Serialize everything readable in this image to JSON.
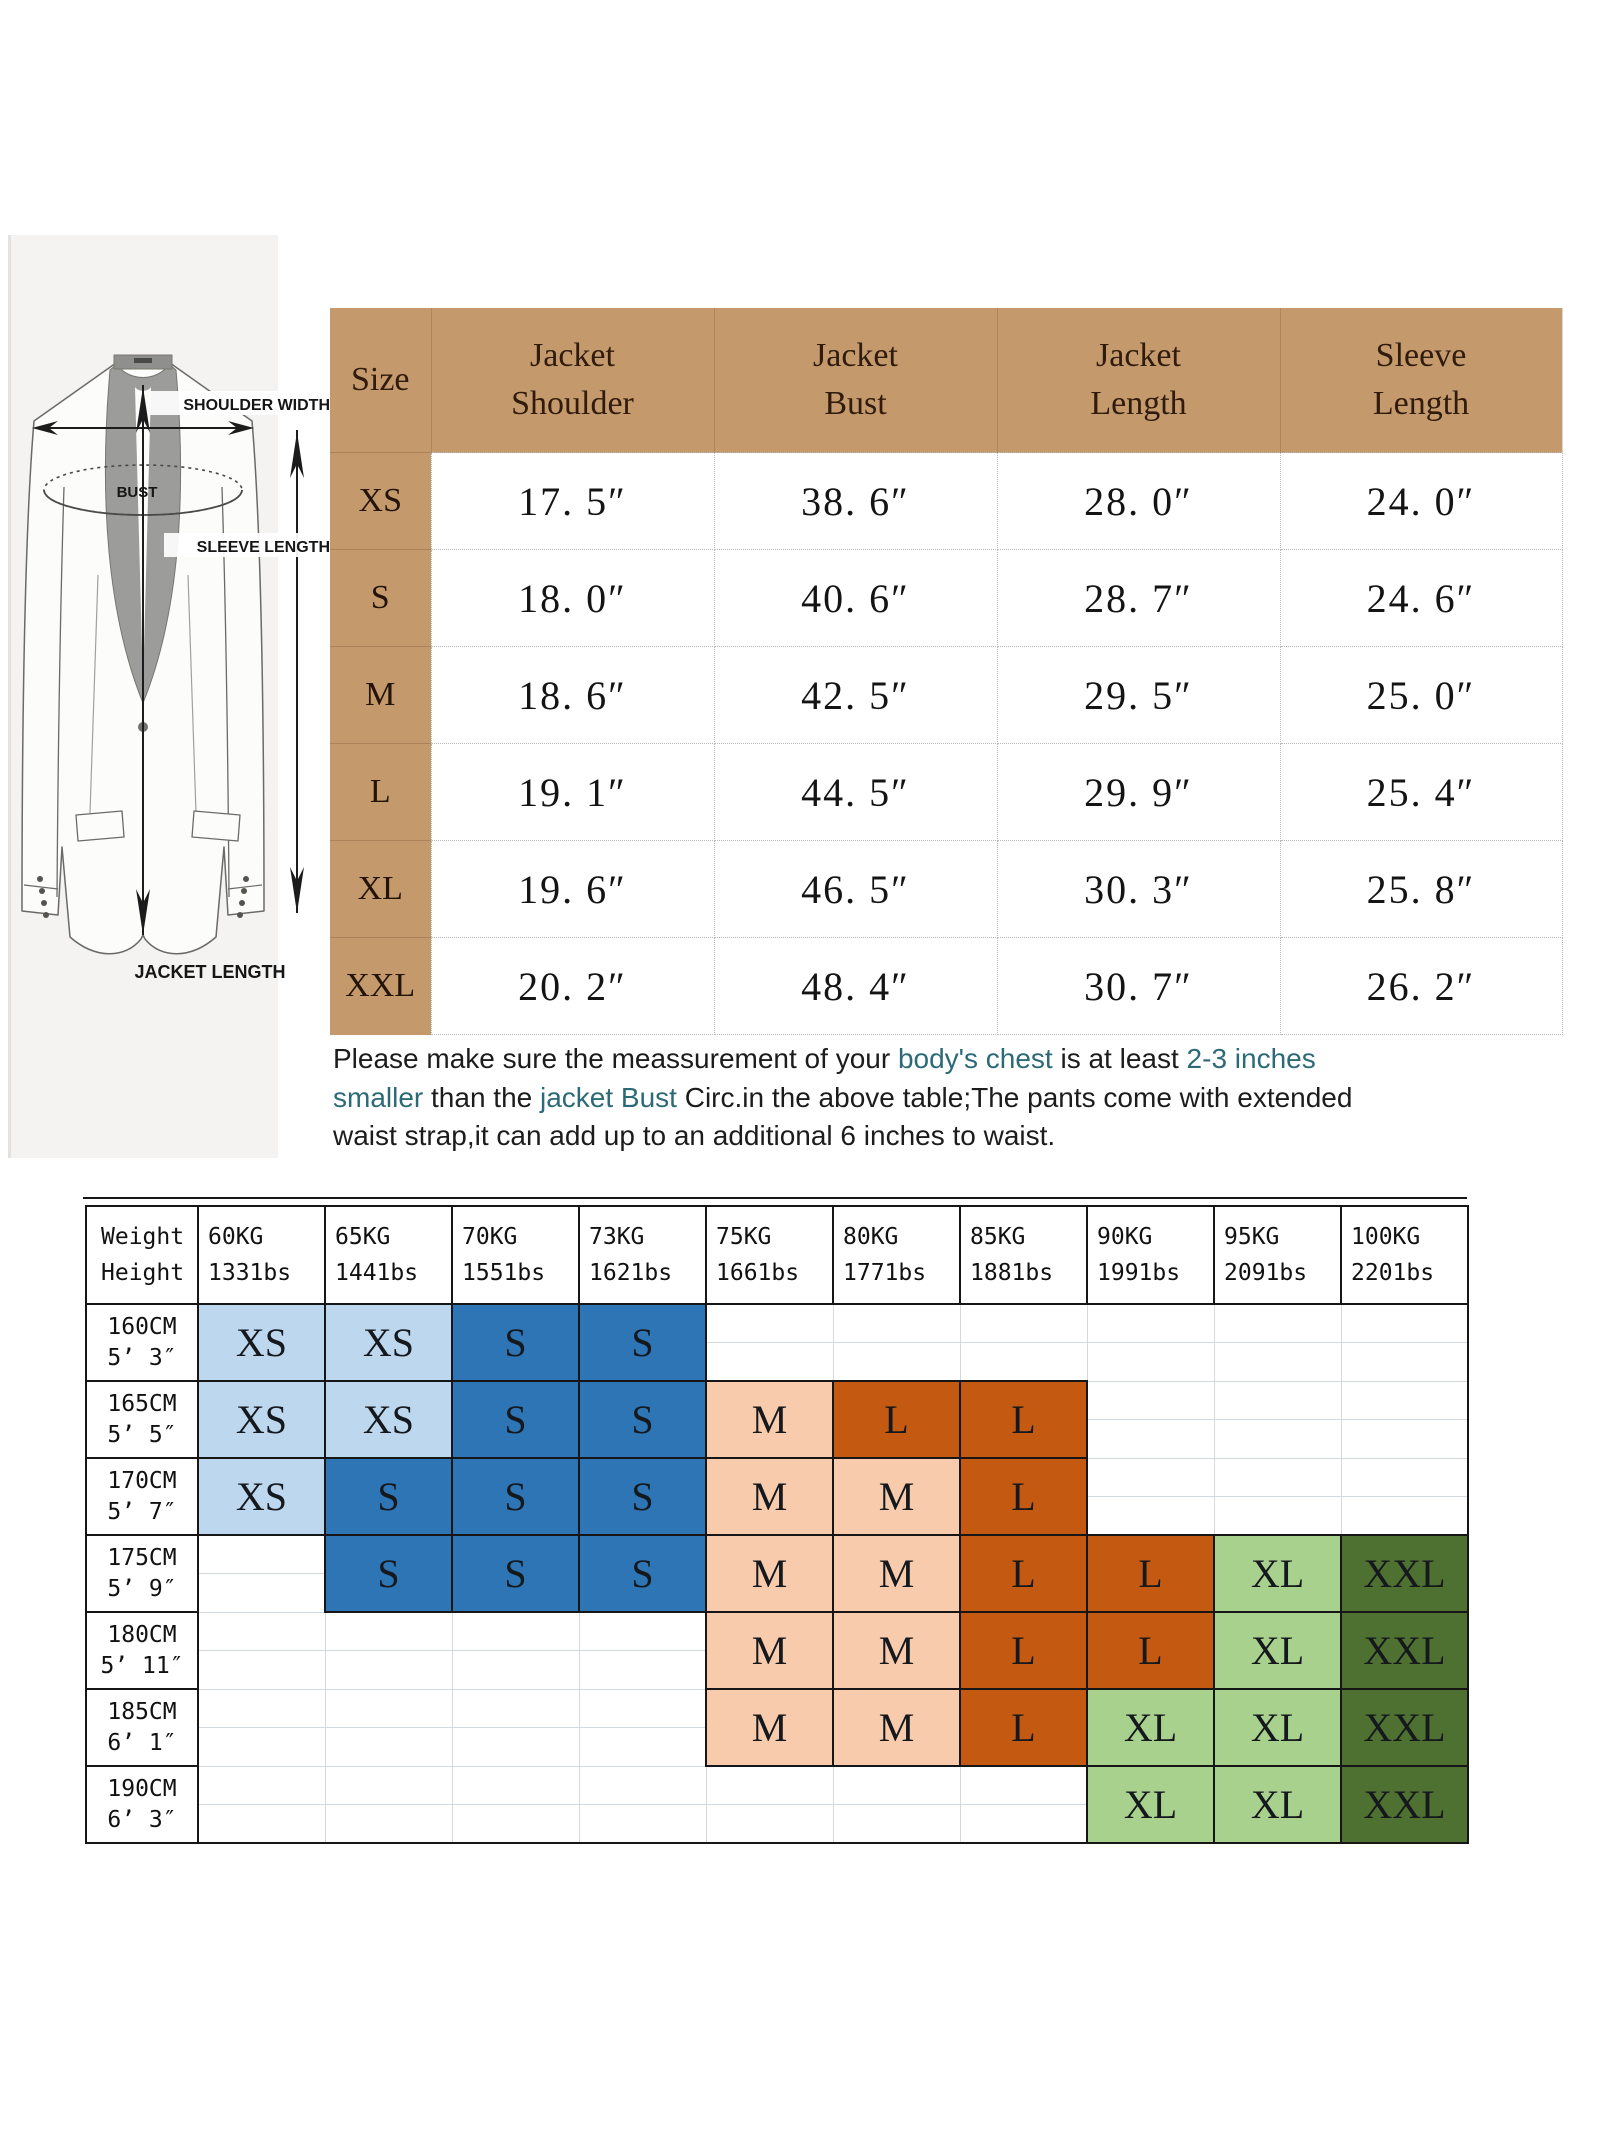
{
  "diagram": {
    "shoulder_label": "SHOULDER WIDTH",
    "bust_label": "BUST",
    "sleeve_label": "SLEEVE LENGTH",
    "length_label": "JACKET LENGTH"
  },
  "size_table": {
    "columns": [
      "Size",
      "Jacket\nShoulder",
      "Jacket\nBust",
      "Jacket\nLength",
      "Sleeve\nLength"
    ],
    "rows": [
      {
        "size": "XS",
        "values": [
          "17. 5″",
          "38. 6″",
          "28. 0″",
          "24. 0″"
        ]
      },
      {
        "size": "S",
        "values": [
          "18. 0″",
          "40. 6″",
          "28. 7″",
          "24. 6″"
        ]
      },
      {
        "size": "M",
        "values": [
          "18. 6″",
          "42. 5″",
          "29. 5″",
          "25. 0″"
        ]
      },
      {
        "size": "L",
        "values": [
          "19. 1″",
          "44. 5″",
          "29. 9″",
          "25. 4″"
        ]
      },
      {
        "size": "XL",
        "values": [
          "19. 6″",
          "46. 5″",
          "30. 3″",
          "25. 8″"
        ]
      },
      {
        "size": "XXL",
        "values": [
          "20. 2″",
          "48. 4″",
          "30. 7″",
          "26. 2″"
        ]
      }
    ]
  },
  "note": {
    "lines": [
      [
        {
          "t": "Please make sure the meassurement of your ",
          "teal": false
        },
        {
          "t": "body's chest",
          "teal": true
        },
        {
          "t": " is at least ",
          "teal": false
        },
        {
          "t": "2-3 inches",
          "teal": true
        }
      ],
      [
        {
          "t": "smaller",
          "teal": true
        },
        {
          "t": " than the ",
          "teal": false
        },
        {
          "t": "jacket Bust",
          "teal": true
        },
        {
          "t": " Circ.in the above table;The pants come with extended",
          "teal": false
        }
      ],
      [
        {
          "t": "waist strap,it can add up to an additional 6 inches to waist.",
          "teal": false
        }
      ]
    ]
  },
  "fit_table": {
    "corner": {
      "top": "Weight",
      "bottom": "Height"
    },
    "weights": [
      {
        "kg": "60KG",
        "lbs": "1331bs"
      },
      {
        "kg": "65KG",
        "lbs": "1441bs"
      },
      {
        "kg": "70KG",
        "lbs": "1551bs"
      },
      {
        "kg": "73KG",
        "lbs": "1621bs"
      },
      {
        "kg": "75KG",
        "lbs": "1661bs"
      },
      {
        "kg": "80KG",
        "lbs": "1771bs"
      },
      {
        "kg": "85KG",
        "lbs": "1881bs"
      },
      {
        "kg": "90KG",
        "lbs": "1991bs"
      },
      {
        "kg": "95KG",
        "lbs": "2091bs"
      },
      {
        "kg": "100KG",
        "lbs": "2201bs"
      }
    ],
    "rows": [
      {
        "cm": "160CM",
        "ft": "5’ 3″",
        "cells": [
          {
            "s": "XS",
            "c": "lightblue"
          },
          {
            "s": "XS",
            "c": "lightblue"
          },
          {
            "s": "S",
            "c": "blue"
          },
          {
            "s": "S",
            "c": "blue"
          },
          null,
          null,
          null,
          null,
          null,
          null
        ]
      },
      {
        "cm": "165CM",
        "ft": "5’ 5″",
        "cells": [
          {
            "s": "XS",
            "c": "lightblue"
          },
          {
            "s": "XS",
            "c": "lightblue"
          },
          {
            "s": "S",
            "c": "blue"
          },
          {
            "s": "S",
            "c": "blue"
          },
          {
            "s": "M",
            "c": "peach"
          },
          {
            "s": "L",
            "c": "orange"
          },
          {
            "s": "L",
            "c": "orange"
          },
          null,
          null,
          null
        ]
      },
      {
        "cm": "170CM",
        "ft": "5’ 7″",
        "cells": [
          {
            "s": "XS",
            "c": "lightblue"
          },
          {
            "s": "S",
            "c": "blue"
          },
          {
            "s": "S",
            "c": "blue"
          },
          {
            "s": "S",
            "c": "blue"
          },
          {
            "s": "M",
            "c": "peach"
          },
          {
            "s": "M",
            "c": "peach"
          },
          {
            "s": "L",
            "c": "orange"
          },
          null,
          null,
          null
        ]
      },
      {
        "cm": "175CM",
        "ft": "5’ 9″",
        "cells": [
          null,
          {
            "s": "S",
            "c": "blue"
          },
          {
            "s": "S",
            "c": "blue"
          },
          {
            "s": "S",
            "c": "blue"
          },
          {
            "s": "M",
            "c": "peach"
          },
          {
            "s": "M",
            "c": "peach"
          },
          {
            "s": "L",
            "c": "orange"
          },
          {
            "s": "L",
            "c": "orange"
          },
          {
            "s": "XL",
            "c": "lightgreen"
          },
          {
            "s": "XXL",
            "c": "darkgreen"
          }
        ]
      },
      {
        "cm": "180CM",
        "ft": "5’ 11″",
        "cells": [
          null,
          null,
          null,
          null,
          {
            "s": "M",
            "c": "peach"
          },
          {
            "s": "M",
            "c": "peach"
          },
          {
            "s": "L",
            "c": "orange"
          },
          {
            "s": "L",
            "c": "orange"
          },
          {
            "s": "XL",
            "c": "lightgreen"
          },
          {
            "s": "XXL",
            "c": "darkgreen"
          }
        ]
      },
      {
        "cm": "185CM",
        "ft": "6’ 1″",
        "cells": [
          null,
          null,
          null,
          null,
          {
            "s": "M",
            "c": "peach"
          },
          {
            "s": "M",
            "c": "peach"
          },
          {
            "s": "L",
            "c": "orange"
          },
          {
            "s": "XL",
            "c": "lightgreen"
          },
          {
            "s": "XL",
            "c": "lightgreen"
          },
          {
            "s": "XXL",
            "c": "darkgreen"
          }
        ]
      },
      {
        "cm": "190CM",
        "ft": "6’ 3″",
        "cells": [
          null,
          null,
          null,
          null,
          null,
          null,
          null,
          {
            "s": "XL",
            "c": "lightgreen"
          },
          {
            "s": "XL",
            "c": "lightgreen"
          },
          {
            "s": "XXL",
            "c": "darkgreen"
          }
        ]
      }
    ]
  },
  "colors": {
    "lightblue": "#bdd7ee",
    "blue": "#2e75b6",
    "peach": "#f8cbad",
    "orange": "#c45911",
    "lightgreen": "#a9d18e",
    "darkgreen": "#4e7031",
    "header_tan": "#c49a6c",
    "teal_text": "#2d6a78"
  }
}
